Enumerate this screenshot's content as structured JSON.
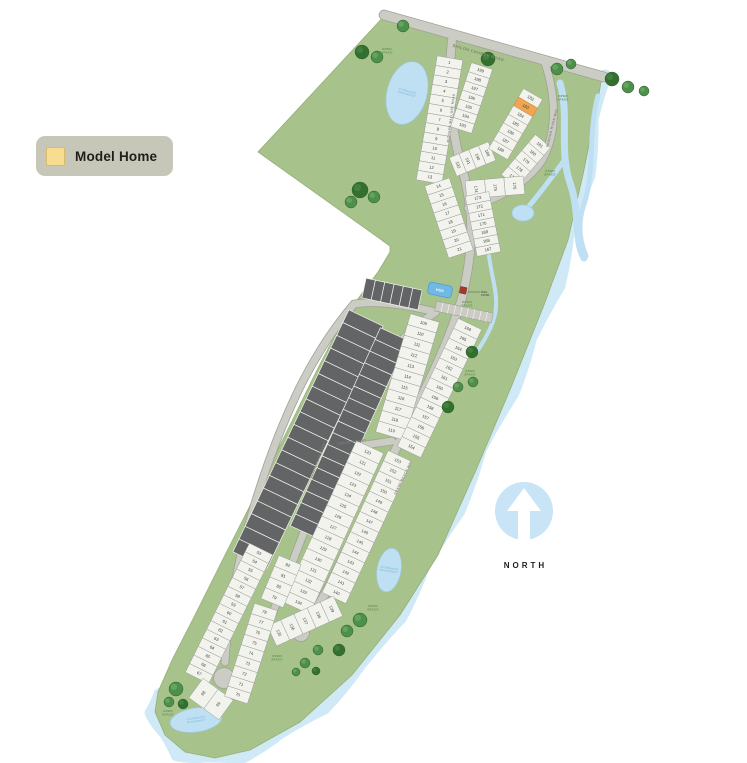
{
  "legend": {
    "label": "Model Home"
  },
  "north": {
    "label": "NORTH"
  },
  "colors": {
    "land": "#a8c28c",
    "lot": "#f3f3ee",
    "lot_stroke": "#999d98",
    "dark_lot": "#626466",
    "road": "#cbccc3",
    "road_edge": "#9fa198",
    "water": "#bfe0f2",
    "water_edge": "#9fcbe4",
    "shore": "#d0e9f6",
    "model_home": "#f0a54e",
    "model_home_legend": "#f8dc90",
    "legend_bg": "#c6c7b8",
    "tree": "#4e8f4c",
    "tree_dark": "#33702f",
    "number": "#43453f",
    "road_label": "#7f8178",
    "open_space": "#5f9150",
    "north_blue": "#c8e4f6",
    "pool": "#6fb9e3",
    "kiosk": "#a03b2c"
  },
  "map": {
    "model_home_lot": "183",
    "open_space_text": [
      "OPEN",
      "SPACE"
    ],
    "pond_label_text": [
      "STORMWATER",
      "MANAGEMENT"
    ],
    "amenity": {
      "pool_label": "HOA",
      "kiosk_label": [
        "MAIL",
        "KIOSK"
      ]
    },
    "land_path": "M386,14 L602,76 L598,100 L584,170 L568,240 L544,305 L512,385 L476,470 L438,555 L400,615 L352,675 L300,722 L250,750 L215,758 L185,752 L165,735 L155,712 L158,692 L172,660 L195,615 L225,555 L258,490 L290,425 L318,368 L342,322 L360,296 L378,272 L390,252 L390,246 L258,152 Z",
    "shore_points": [
      [
        602,
        76
      ],
      [
        596,
        120
      ],
      [
        586,
        175
      ],
      [
        572,
        232
      ],
      [
        556,
        285
      ],
      [
        534,
        340
      ],
      [
        510,
        392
      ],
      [
        484,
        450
      ],
      [
        456,
        510
      ],
      [
        428,
        566
      ],
      [
        398,
        616
      ],
      [
        362,
        668
      ],
      [
        322,
        706
      ],
      [
        282,
        736
      ],
      [
        240,
        755
      ],
      [
        205,
        760
      ],
      [
        178,
        752
      ],
      [
        162,
        735
      ],
      [
        154,
        712
      ],
      [
        156,
        694
      ]
    ],
    "roads": [
      {
        "name": "shiloh-church-road",
        "d": "M384,15 L604,77",
        "w": 9,
        "label": {
          "text": "SHILOH CHURCH ROAD",
          "x": 478,
          "y": 54,
          "rot": 16,
          "size": 4
        }
      },
      {
        "name": "richard-mallory-road",
        "d": "M452,40 C447,88 451,130 462,168 C471,200 473,228 470,252 C468,272 465,286 462,298",
        "w": 8,
        "label": {
          "text": "RICHARD MALLORY ROAD",
          "x": 452,
          "y": 118,
          "rot": -83,
          "size": 3.2
        }
      },
      {
        "name": "winding-river-way",
        "d": "M544,60 C556,94 558,134 541,162 C524,186 496,199 468,208",
        "w": 7,
        "label": {
          "text": "WINDING RIVER WAY",
          "x": 553,
          "y": 128,
          "rot": -76,
          "size": 3.2
        }
      },
      {
        "name": "grand-beach-way",
        "d": "M462,298 C450,338 432,376 410,420 C388,466 364,514 342,560 C327,592 314,614 304,628",
        "w": 8,
        "label": {
          "text": "GRAND BEACH WAY",
          "x": 404,
          "y": 478,
          "rot": -64,
          "size": 3.2
        }
      },
      {
        "name": "loop-road-west",
        "d": "M436,312 C410,306 380,300 354,304 C330,332 308,368 292,404 C272,448 256,496 243,546 C233,586 227,630 225,662",
        "w": 7,
        "label": null
      },
      {
        "name": "arrowhead-court",
        "d": "M436,312 C408,330 388,352 368,390 C348,428 330,466 314,506 C300,542 282,590 266,630 C258,650 246,668 234,676",
        "w": 7,
        "label": {
          "text": "ARROWHEAD COURT",
          "x": 319,
          "y": 460,
          "rot": -69,
          "size": 3.2
        }
      },
      {
        "name": "susan-street",
        "d": "M310,452 C338,449 366,445 392,441",
        "w": 7,
        "label": {
          "text": "SUSAN STREET",
          "x": 352,
          "y": 443,
          "rot": -7,
          "size": 3.2
        }
      }
    ],
    "culdesacs": [
      {
        "x": 224,
        "y": 678,
        "r": 10
      },
      {
        "x": 301,
        "y": 633,
        "r": 8
      }
    ],
    "lot_strips": [
      {
        "id": "lots-1-13",
        "x1": 450,
        "y1": 58,
        "x2": 429,
        "y2": 182,
        "depth": 26,
        "numbers": [
          1,
          2,
          3,
          4,
          5,
          6,
          7,
          8,
          9,
          10,
          11,
          12,
          13
        ]
      },
      {
        "id": "lots-14-21",
        "x1": 437,
        "y1": 182,
        "x2": 461,
        "y2": 254,
        "depth": 26,
        "numbers": [
          14,
          15,
          16,
          17,
          18,
          19,
          20,
          21
        ]
      },
      {
        "id": "lots-199-193",
        "x1": 482,
        "y1": 66,
        "x2": 461,
        "y2": 130,
        "depth": 22,
        "numbers": [
          199,
          198,
          197,
          196,
          195,
          194,
          193
        ]
      },
      {
        "id": "lots-192-189",
        "x1": 453,
        "y1": 167,
        "x2": 492,
        "y2": 151,
        "depth": 20,
        "numbers": [
          192,
          191,
          190,
          189
        ]
      },
      {
        "id": "lots-182-188",
        "x1": 533,
        "y1": 94,
        "x2": 498,
        "y2": 154,
        "depth": 22,
        "numbers": [
          182,
          183,
          184,
          185,
          186,
          187,
          188
        ]
      },
      {
        "id": "lots-181-177",
        "x1": 543,
        "y1": 141,
        "x2": 509,
        "y2": 181,
        "depth": 20,
        "numbers": [
          181,
          180,
          179,
          178,
          177
        ]
      },
      {
        "id": "lots-174-176",
        "x1": 466,
        "y1": 190,
        "x2": 524,
        "y2": 185,
        "depth": 18,
        "numbers": [
          174,
          175,
          176
        ]
      },
      {
        "id": "lots-173-167",
        "x1": 477,
        "y1": 194,
        "x2": 489,
        "y2": 254,
        "depth": 24,
        "numbers": [
          173,
          172,
          171,
          170,
          169,
          168,
          167
        ]
      },
      {
        "id": "lots-109-119",
        "x1": 425,
        "y1": 318,
        "x2": 390,
        "y2": 436,
        "depth": 30,
        "numbers": [
          109,
          110,
          111,
          112,
          113,
          114,
          115,
          116,
          117,
          118,
          119
        ]
      },
      {
        "id": "lots-120-134",
        "x1": 370,
        "y1": 447,
        "x2": 296,
        "y2": 608,
        "depth": 30,
        "numbers": [
          120,
          121,
          122,
          123,
          124,
          125,
          126,
          127,
          128,
          129,
          130,
          131,
          132,
          133,
          134
        ]
      },
      {
        "id": "lots-166-154",
        "x1": 470,
        "y1": 324,
        "x2": 409,
        "y2": 452,
        "depth": 26,
        "numbers": [
          166,
          165,
          164,
          163,
          162,
          161,
          160,
          159,
          158,
          157,
          156,
          155,
          154
        ]
      },
      {
        "id": "lots-153-140",
        "x1": 400,
        "y1": 456,
        "x2": 334,
        "y2": 598,
        "depth": 26,
        "numbers": [
          153,
          152,
          151,
          150,
          149,
          148,
          147,
          146,
          145,
          144,
          143,
          142,
          141,
          140
        ]
      },
      {
        "id": "lots-135-139",
        "x1": 272,
        "y1": 636,
        "x2": 338,
        "y2": 606,
        "depth": 22,
        "numbers": [
          135,
          136,
          137,
          138,
          139
        ]
      },
      {
        "id": "lots-53-67",
        "x1": 261,
        "y1": 549,
        "x2": 197,
        "y2": 678,
        "depth": 26,
        "numbers": [
          53,
          54,
          55,
          56,
          57,
          58,
          59,
          60,
          61,
          62,
          63,
          64,
          65,
          66,
          67
        ]
      },
      {
        "id": "lots-68-69",
        "x1": 196,
        "y1": 688,
        "x2": 226,
        "y2": 710,
        "depth": 24,
        "numbers": [
          68,
          69
        ]
      },
      {
        "id": "lots-78-70",
        "x1": 266,
        "y1": 607,
        "x2": 236,
        "y2": 700,
        "depth": 24,
        "numbers": [
          78,
          77,
          76,
          75,
          74,
          73,
          72,
          71,
          70
        ]
      },
      {
        "id": "lots-82-79",
        "x1": 290,
        "y1": 560,
        "x2": 272,
        "y2": 603,
        "depth": 24,
        "numbers": [
          82,
          81,
          80,
          79
        ]
      }
    ],
    "dark_strips": [
      {
        "x1": 366,
        "y1": 318,
        "x2": 250,
        "y2": 560,
        "depth": 38,
        "count": 19
      },
      {
        "x1": 394,
        "y1": 334,
        "x2": 304,
        "y2": 532,
        "depth": 30,
        "count": 17
      },
      {
        "x1": 364,
        "y1": 288,
        "x2": 420,
        "y2": 300,
        "depth": 20,
        "count": 6
      }
    ],
    "ponds": [
      {
        "cx": 407,
        "cy": 93,
        "rx": 20,
        "ry": 32,
        "rot": 15,
        "label": true
      },
      {
        "cx": 523,
        "cy": 213,
        "rx": 11,
        "ry": 8,
        "rot": 0,
        "label": false
      },
      {
        "cx": 389,
        "cy": 570,
        "rx": 12,
        "ry": 22,
        "rot": 10,
        "label": true
      },
      {
        "cx": 196,
        "cy": 720,
        "rx": 26,
        "ry": 12,
        "rot": -8,
        "label": true
      }
    ],
    "streams": [
      {
        "d": "M560,83 C570,118 558,150 571,186 C580,214 574,240 584,258",
        "w": 7
      },
      {
        "d": "M598,96 C588,132 595,172 584,204 C577,224 580,242 586,256",
        "w": 5
      },
      {
        "d": "M566,158 C550,180 536,198 525,211",
        "w": 5
      },
      {
        "d": "M489,256 C492,280 500,298 494,318 C490,332 482,344 474,356",
        "w": 4
      }
    ],
    "trees": [
      {
        "x": 362,
        "y": 52,
        "r": 7
      },
      {
        "x": 377,
        "y": 57,
        "r": 6
      },
      {
        "x": 403,
        "y": 26,
        "r": 6
      },
      {
        "x": 488,
        "y": 59,
        "r": 7
      },
      {
        "x": 557,
        "y": 69,
        "r": 6
      },
      {
        "x": 571,
        "y": 64,
        "r": 5
      },
      {
        "x": 612,
        "y": 79,
        "r": 7
      },
      {
        "x": 628,
        "y": 87,
        "r": 6
      },
      {
        "x": 644,
        "y": 91,
        "r": 5
      },
      {
        "x": 360,
        "y": 190,
        "r": 8
      },
      {
        "x": 374,
        "y": 197,
        "r": 6
      },
      {
        "x": 351,
        "y": 202,
        "r": 6
      },
      {
        "x": 472,
        "y": 352,
        "r": 6
      },
      {
        "x": 473,
        "y": 382,
        "r": 5
      },
      {
        "x": 458,
        "y": 387,
        "r": 5
      },
      {
        "x": 448,
        "y": 407,
        "r": 6
      },
      {
        "x": 360,
        "y": 620,
        "r": 7
      },
      {
        "x": 347,
        "y": 631,
        "r": 6
      },
      {
        "x": 339,
        "y": 650,
        "r": 6
      },
      {
        "x": 318,
        "y": 650,
        "r": 5
      },
      {
        "x": 305,
        "y": 663,
        "r": 5
      },
      {
        "x": 316,
        "y": 671,
        "r": 4
      },
      {
        "x": 176,
        "y": 689,
        "r": 7
      },
      {
        "x": 169,
        "y": 702,
        "r": 5
      },
      {
        "x": 183,
        "y": 704,
        "r": 5
      },
      {
        "x": 296,
        "y": 672,
        "r": 4
      }
    ],
    "open_space_labels": [
      {
        "x": 387,
        "y": 50
      },
      {
        "x": 563,
        "y": 97
      },
      {
        "x": 550,
        "y": 172
      },
      {
        "x": 467,
        "y": 303
      },
      {
        "x": 470,
        "y": 372
      },
      {
        "x": 373,
        "y": 607
      },
      {
        "x": 277,
        "y": 657
      },
      {
        "x": 168,
        "y": 712
      }
    ]
  }
}
